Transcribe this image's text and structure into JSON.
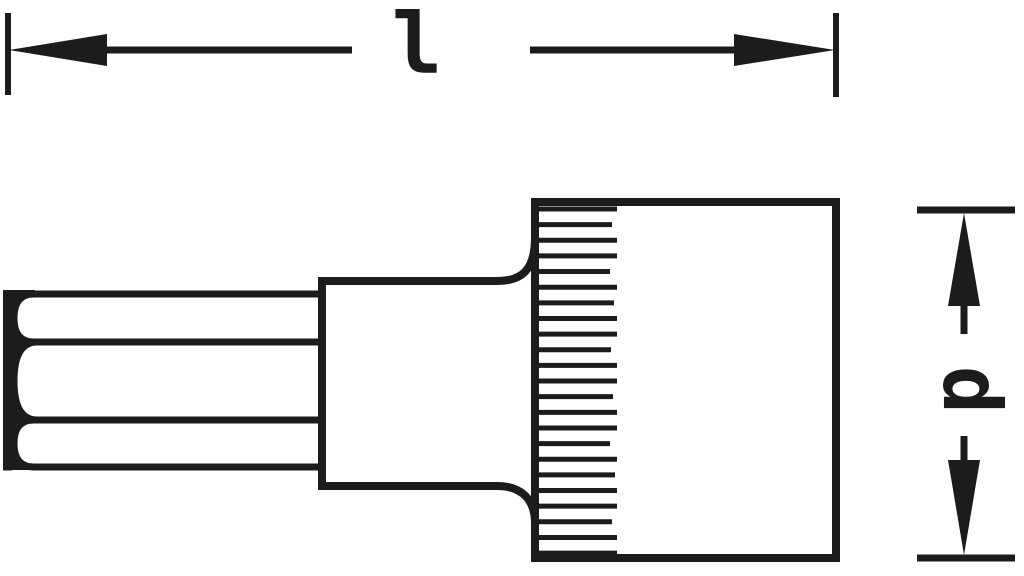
{
  "drawing": {
    "background_color": "#ffffff",
    "ink_color": "#1c1c1c",
    "dimension_length": {
      "label": "l"
    },
    "dimension_diameter": {
      "label": "d"
    },
    "knurl": {
      "x": 539,
      "y_start": 209,
      "pitch": 15.64,
      "thickness": 5,
      "lengths": [
        78,
        73,
        78,
        78,
        71,
        78,
        75,
        78,
        78,
        72,
        78,
        78,
        74,
        78,
        78,
        71,
        78,
        76,
        78,
        78,
        73,
        78,
        78
      ]
    }
  }
}
